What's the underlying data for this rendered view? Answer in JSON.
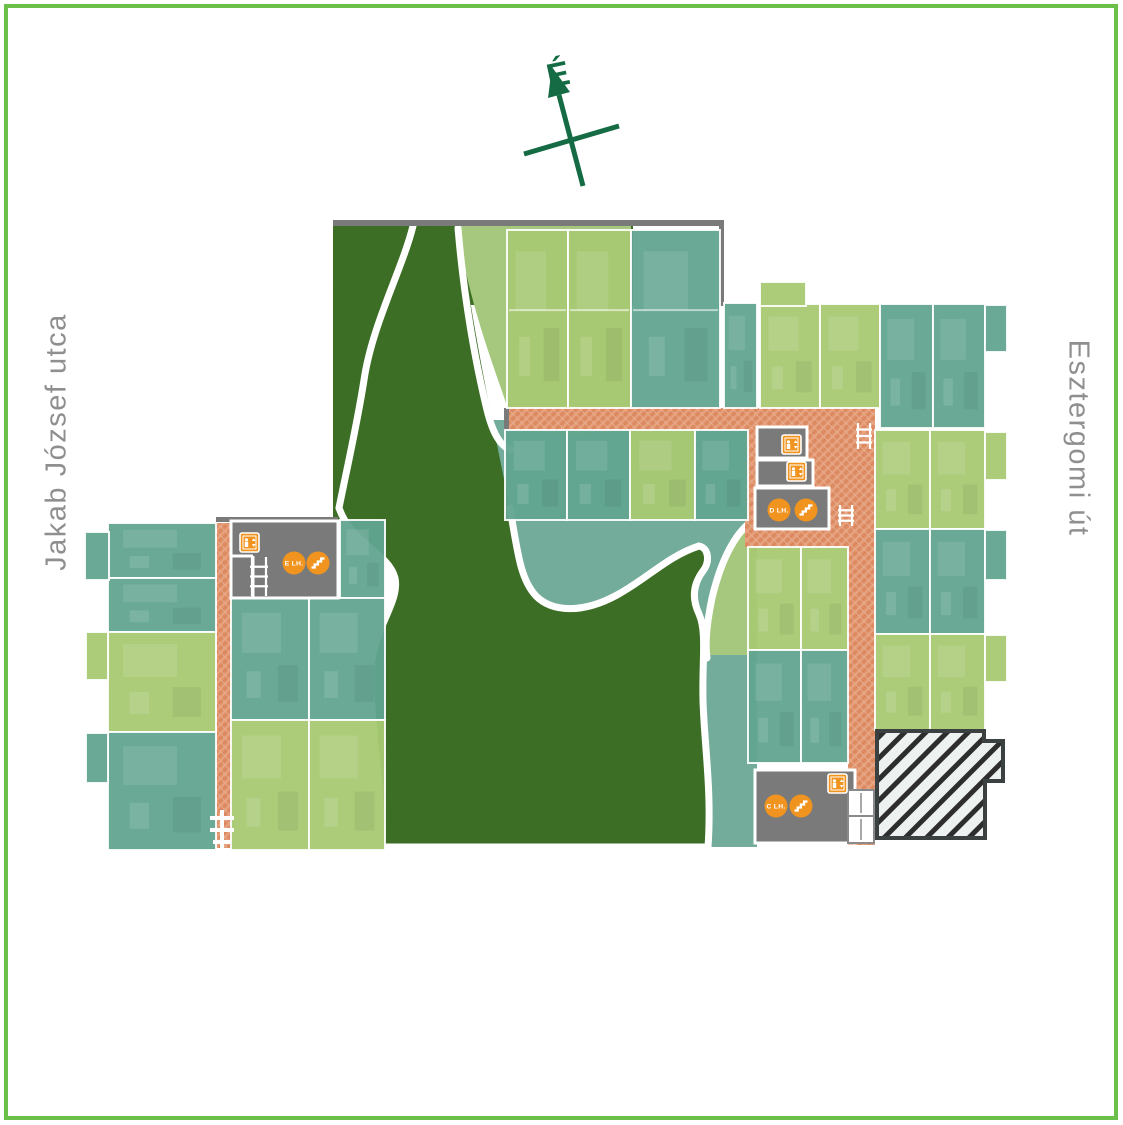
{
  "compass": {
    "label": "É",
    "color": "#156b44"
  },
  "streets": {
    "left": "Jakab József utca",
    "right": "Esztergomi út",
    "color": "#8f8f8f"
  },
  "colors": {
    "frame_green": "#6cc04a",
    "garden_dark": "#3c6e28",
    "garden_pale": "#a6c77e",
    "garden_teal": "#74ac9c",
    "apartment_teal": "#61a490",
    "apartment_green": "#a8c973",
    "corridor": "#e08f66",
    "core_gray": "#7a7a7a",
    "icon_orange": "#f0941f",
    "wall_gray": "#7a7a7a",
    "hatch_bg": "#edf1f0",
    "hatch_line": "#2d2d2d",
    "path_white": "#ffffff"
  },
  "plan": {
    "garden": {
      "dark_rects": [
        [
          333,
          225,
          300,
          80
        ],
        [
          333,
          225,
          127,
          295
        ]
      ],
      "teal_rect": [
        437,
        420,
        320,
        238
      ],
      "teal_strip": [
        695,
        655,
        62,
        192
      ],
      "pale_blob": "M457,226 H631 V408 C631,425 615,432 590,434 C550,437 515,430 505,400 C495,370 468,300 457,226 Z",
      "pale_patch": "M757,518 C738,528 722,556 712,598 C707,622 705,644 707,658 L757,658 Z",
      "dark_blob": "M339,508 C352,545 388,552 395,578 C400,603 373,628 371,670 C369,722 384,788 380,847 L708,847 C712,790 704,742 703,700 C702,660 707,632 699,614 C691,597 694,583 703,571 C710,562 709,548 699,546 C668,556 648,578 617,595 C582,614 552,612 536,596 C521,580 518,556 510,508 C500,458 472,330 460,230 L413,226 C402,270 372,325 364,380 C357,425 347,468 339,508 Z",
      "white_paths": [
        "M757,518 C738,528 722,556 712,598 C707,622 705,644 707,658",
        "M413,226 C402,270 372,325 364,380 C357,425 347,468 339,508",
        "M458,228 C464,300 476,365 487,410 C493,434 500,445 510,450",
        "M339,508 C352,545 388,552 395,578 C400,603 373,628 371,670 C369,722 384,788 380,847 L708,847 C712,790 704,742 703,700 C702,660 707,632 699,614 C691,597 694,583 703,571 C710,562 709,548 699,546 C668,556 648,578 617,595 C582,614 552,612 536,596 C521,580 518,556 510,508"
      ]
    },
    "corridors": [
      [
        507,
        408,
        368,
        23
      ],
      [
        848,
        408,
        27,
        437
      ],
      [
        745,
        415,
        103,
        132
      ],
      [
        216,
        523,
        15,
        325
      ]
    ],
    "walls": [
      [
        333,
        220,
        391,
        6
      ],
      [
        719,
        220,
        5,
        86
      ],
      [
        216,
        517,
        122,
        5
      ],
      [
        504,
        408,
        5,
        23
      ]
    ],
    "apartments": [
      [
        507,
        230,
        61,
        178,
        "g"
      ],
      [
        568,
        230,
        63,
        178,
        "g"
      ],
      [
        631,
        230,
        89,
        178,
        "t"
      ],
      [
        724,
        303,
        33,
        105,
        "t"
      ],
      [
        760,
        304,
        60,
        104,
        "g"
      ],
      [
        820,
        304,
        60,
        104,
        "g"
      ],
      [
        880,
        304,
        53,
        124,
        "t"
      ],
      [
        933,
        304,
        52,
        124,
        "t"
      ],
      [
        505,
        430,
        62,
        90,
        "t"
      ],
      [
        567,
        430,
        63,
        90,
        "t"
      ],
      [
        630,
        430,
        65,
        90,
        "g"
      ],
      [
        695,
        430,
        53,
        90,
        "t"
      ],
      [
        748,
        547,
        53,
        103,
        "g"
      ],
      [
        801,
        547,
        47,
        103,
        "g"
      ],
      [
        748,
        650,
        53,
        113,
        "t"
      ],
      [
        801,
        650,
        47,
        113,
        "t"
      ],
      [
        875,
        430,
        55,
        99,
        "g"
      ],
      [
        930,
        430,
        55,
        99,
        "g"
      ],
      [
        875,
        529,
        55,
        105,
        "t"
      ],
      [
        930,
        529,
        55,
        105,
        "t"
      ],
      [
        875,
        634,
        55,
        96,
        "g"
      ],
      [
        930,
        634,
        55,
        96,
        "g"
      ],
      [
        108,
        523,
        108,
        55,
        "t"
      ],
      [
        108,
        578,
        108,
        54,
        "t"
      ],
      [
        108,
        632,
        108,
        100,
        "g"
      ],
      [
        108,
        732,
        108,
        118,
        "t"
      ],
      [
        340,
        520,
        45,
        78,
        "t"
      ],
      [
        231,
        598,
        78,
        122,
        "t"
      ],
      [
        309,
        598,
        76,
        122,
        "t"
      ],
      [
        231,
        720,
        78,
        130,
        "g"
      ],
      [
        309,
        720,
        76,
        130,
        "g"
      ]
    ],
    "balconies": [
      [
        85,
        532,
        24,
        48,
        "t"
      ],
      [
        86,
        632,
        22,
        48,
        "g"
      ],
      [
        86,
        733,
        22,
        50,
        "t"
      ],
      [
        760,
        282,
        46,
        24,
        "g"
      ],
      [
        985,
        305,
        22,
        47,
        "t"
      ],
      [
        985,
        432,
        22,
        48,
        "g"
      ],
      [
        985,
        530,
        22,
        50,
        "t"
      ],
      [
        985,
        635,
        22,
        47,
        "g"
      ]
    ],
    "cores": {
      "gray_rooms": [
        [
          231,
          521,
          107,
          77
        ],
        [
          757,
          427,
          50,
          31
        ],
        [
          757,
          460,
          56,
          26
        ],
        [
          755,
          488,
          74,
          41
        ],
        [
          755,
          770,
          100,
          73
        ]
      ],
      "white_rooms": [
        [
          848,
          790,
          26,
          26
        ],
        [
          848,
          816,
          26,
          27
        ]
      ],
      "partitions": [
        [
          231,
          556,
          253,
          556
        ],
        [
          253,
          556,
          253,
          597
        ]
      ],
      "ladders": [
        [
          250,
          557,
          18,
          39
        ],
        [
          856,
          423,
          16,
          26
        ],
        [
          838,
          505,
          16,
          21
        ]
      ]
    },
    "staircase_labels": [
      {
        "text": "E LH.",
        "cx": 294,
        "cy": 563
      },
      {
        "text": "D LH.",
        "cx": 779,
        "cy": 510
      },
      {
        "text": "C LH.",
        "cx": 776,
        "cy": 806
      }
    ],
    "stairs_icons": [
      {
        "cx": 318,
        "cy": 563
      },
      {
        "cx": 806,
        "cy": 510
      },
      {
        "cx": 801,
        "cy": 806
      }
    ],
    "elevator_icons": [
      [
        240,
        533
      ],
      [
        782,
        435
      ],
      [
        787,
        462
      ],
      [
        828,
        774
      ]
    ],
    "entrance_steps": "M222,810 V848 M210,818 H234 M210,830 H234 M213,842 H231",
    "hatched_building": "M877,731 L984,731 L984,741 L1003,741 L1003,781 L985,781 L985,838 L877,838 Z"
  }
}
